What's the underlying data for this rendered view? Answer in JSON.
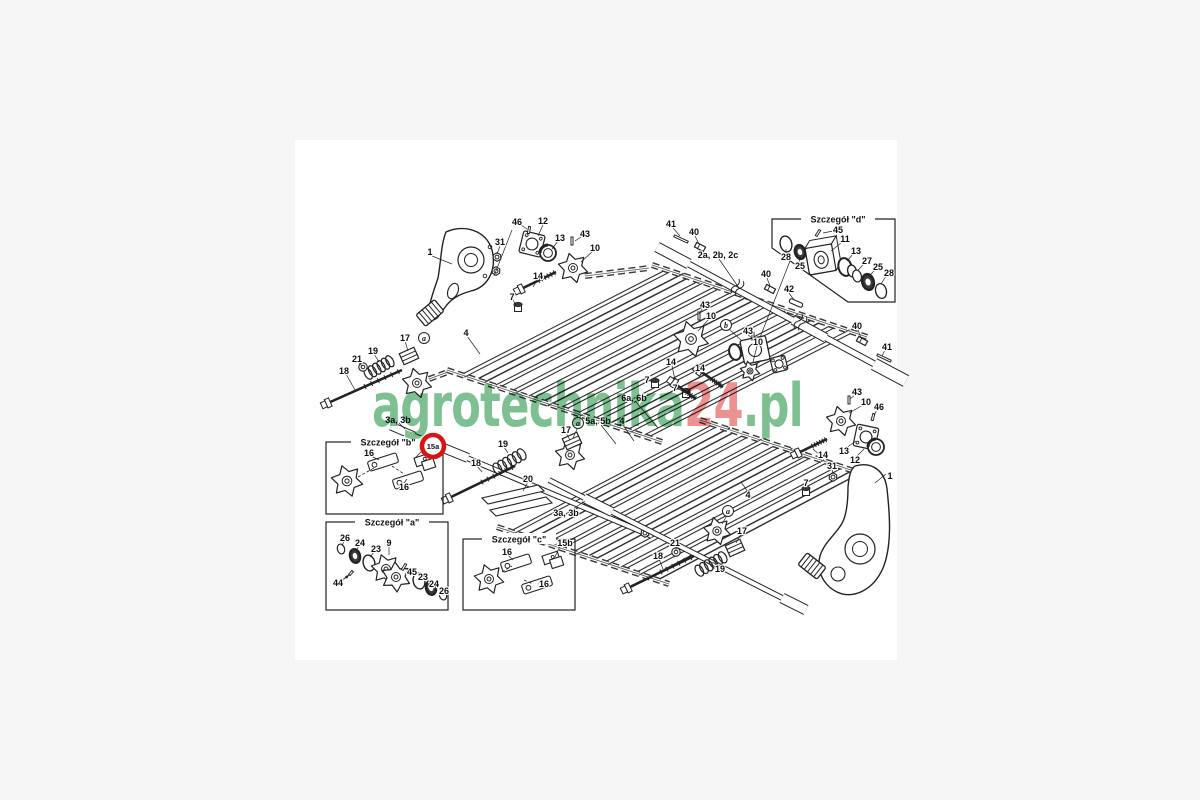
{
  "page": {
    "bg": "#f6f6f6",
    "canvas": "#ffffff",
    "line": "#222222"
  },
  "watermark": {
    "part1": "agrotechnika",
    "part2": "24",
    "part3": ".pl",
    "green": "#7fc093",
    "red": "#ec9090"
  },
  "highlight": {
    "label": "15a",
    "color": "#d41616"
  },
  "details": [
    {
      "id": "b",
      "title": "Szczegół \"b\""
    },
    {
      "id": "a",
      "title": "Szczegół \"a\""
    },
    {
      "id": "c",
      "title": "Szczegół \"c\""
    },
    {
      "id": "d",
      "title": "Szczegół \"d\""
    }
  ],
  "callouts": [
    {
      "t": "1",
      "x": 430,
      "y": 252
    },
    {
      "t": "31",
      "x": 500,
      "y": 242
    },
    {
      "t": "46",
      "x": 517,
      "y": 222
    },
    {
      "t": "12",
      "x": 543,
      "y": 221
    },
    {
      "t": "13",
      "x": 560,
      "y": 238
    },
    {
      "t": "43",
      "x": 585,
      "y": 234
    },
    {
      "t": "10",
      "x": 595,
      "y": 248
    },
    {
      "t": "14",
      "x": 538,
      "y": 276
    },
    {
      "t": "7",
      "x": 512,
      "y": 297
    },
    {
      "t": "4",
      "x": 466,
      "y": 333
    },
    {
      "t": "17",
      "x": 405,
      "y": 338
    },
    {
      "t": "19",
      "x": 373,
      "y": 351
    },
    {
      "t": "21",
      "x": 357,
      "y": 359
    },
    {
      "t": "18",
      "x": 344,
      "y": 371
    },
    {
      "t": "a",
      "x": 424,
      "y": 338,
      "k": "circ"
    },
    {
      "t": "41",
      "x": 671,
      "y": 224
    },
    {
      "t": "40",
      "x": 694,
      "y": 232
    },
    {
      "t": "2a, 2b, 2c",
      "x": 718,
      "y": 255
    },
    {
      "t": "40",
      "x": 766,
      "y": 274
    },
    {
      "t": "42",
      "x": 789,
      "y": 289
    },
    {
      "t": "40",
      "x": 857,
      "y": 326
    },
    {
      "t": "41",
      "x": 887,
      "y": 347
    },
    {
      "t": "43",
      "x": 705,
      "y": 305
    },
    {
      "t": "10",
      "x": 711,
      "y": 316
    },
    {
      "t": "b",
      "x": 726,
      "y": 325,
      "k": "circ"
    },
    {
      "t": "43",
      "x": 748,
      "y": 331
    },
    {
      "t": "10",
      "x": 758,
      "y": 342
    },
    {
      "t": "14",
      "x": 671,
      "y": 362
    },
    {
      "t": "14",
      "x": 700,
      "y": 368
    },
    {
      "t": "7",
      "x": 647,
      "y": 380
    },
    {
      "t": "7",
      "x": 675,
      "y": 388
    },
    {
      "t": "6a, 6b",
      "x": 634,
      "y": 398
    },
    {
      "t": "5a, 5b",
      "x": 598,
      "y": 421
    },
    {
      "t": "4",
      "x": 622,
      "y": 421
    },
    {
      "t": "a",
      "x": 578,
      "y": 423,
      "k": "circ"
    },
    {
      "t": "17",
      "x": 566,
      "y": 430
    },
    {
      "t": "19",
      "x": 503,
      "y": 444
    },
    {
      "t": "18",
      "x": 476,
      "y": 463
    },
    {
      "t": "20",
      "x": 528,
      "y": 479
    },
    {
      "t": "3a, 3b",
      "x": 398,
      "y": 420
    },
    {
      "t": "3a, 3b",
      "x": 566,
      "y": 513
    },
    {
      "t": "4",
      "x": 748,
      "y": 495
    },
    {
      "t": "a",
      "x": 728,
      "y": 511,
      "k": "circ"
    },
    {
      "t": "17",
      "x": 742,
      "y": 531
    },
    {
      "t": "21",
      "x": 675,
      "y": 543
    },
    {
      "t": "18",
      "x": 658,
      "y": 556
    },
    {
      "t": "19",
      "x": 720,
      "y": 569
    },
    {
      "t": "7",
      "x": 806,
      "y": 483
    },
    {
      "t": "43",
      "x": 857,
      "y": 392
    },
    {
      "t": "10",
      "x": 866,
      "y": 402
    },
    {
      "t": "46",
      "x": 879,
      "y": 407
    },
    {
      "t": "13",
      "x": 844,
      "y": 451
    },
    {
      "t": "12",
      "x": 855,
      "y": 460
    },
    {
      "t": "14",
      "x": 823,
      "y": 455
    },
    {
      "t": "31",
      "x": 832,
      "y": 466
    },
    {
      "t": "1",
      "x": 890,
      "y": 476
    },
    {
      "t": "45",
      "x": 838,
      "y": 230
    },
    {
      "t": "11",
      "x": 845,
      "y": 239
    },
    {
      "t": "13",
      "x": 856,
      "y": 251
    },
    {
      "t": "27",
      "x": 867,
      "y": 261
    },
    {
      "t": "25",
      "x": 878,
      "y": 267
    },
    {
      "t": "28",
      "x": 889,
      "y": 273
    },
    {
      "t": "28",
      "x": 786,
      "y": 257
    },
    {
      "t": "25",
      "x": 800,
      "y": 266
    },
    {
      "t": "16",
      "x": 369,
      "y": 453
    },
    {
      "t": "16",
      "x": 404,
      "y": 487
    },
    {
      "t": "15a",
      "x": 433,
      "y": 446,
      "k": "red"
    },
    {
      "t": "26",
      "x": 345,
      "y": 538
    },
    {
      "t": "24",
      "x": 360,
      "y": 543
    },
    {
      "t": "23",
      "x": 376,
      "y": 549
    },
    {
      "t": "9",
      "x": 389,
      "y": 543
    },
    {
      "t": "44",
      "x": 338,
      "y": 583
    },
    {
      "t": "45",
      "x": 412,
      "y": 572
    },
    {
      "t": "23",
      "x": 423,
      "y": 577
    },
    {
      "t": "24",
      "x": 434,
      "y": 584
    },
    {
      "t": "26",
      "x": 444,
      "y": 591
    },
    {
      "t": "16",
      "x": 507,
      "y": 552
    },
    {
      "t": "15b",
      "x": 565,
      "y": 543
    },
    {
      "t": "16",
      "x": 544,
      "y": 584
    }
  ]
}
